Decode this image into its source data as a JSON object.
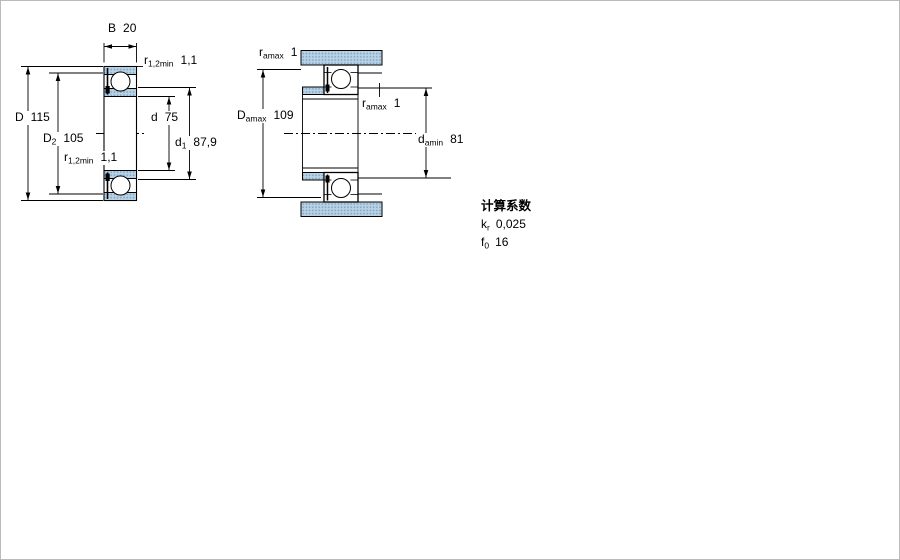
{
  "drawing": {
    "type": "bearing-cross-section-technical-drawing",
    "left_figure": {
      "dims": {
        "B": {
          "sym": "B",
          "sub": "",
          "value": "20"
        },
        "D": {
          "sym": "D",
          "sub": "",
          "value": "115"
        },
        "D2": {
          "sym": "D",
          "sub": "2",
          "value": "105"
        },
        "d": {
          "sym": "d",
          "sub": "",
          "value": "75"
        },
        "d1": {
          "sym": "d",
          "sub": "1",
          "value": "87,9"
        },
        "r12_top": {
          "sym": "r",
          "sub": "1,2min",
          "value": "1,1"
        },
        "r12_bot": {
          "sym": "r",
          "sub": "1,2min",
          "value": "1,1"
        }
      }
    },
    "right_figure": {
      "dims": {
        "ra_top": {
          "sym": "r",
          "sub": "amax",
          "value": "1"
        },
        "Damax": {
          "sym": "D",
          "sub": "amax",
          "value": "109"
        },
        "ra_mid": {
          "sym": "r",
          "sub": "amax",
          "value": "1"
        },
        "damin": {
          "sym": "d",
          "sub": "amin",
          "value": "81"
        }
      }
    },
    "calculation_factors": {
      "title": "计算系数",
      "kr": {
        "sym": "k",
        "sub": "r",
        "value": "0,025"
      },
      "f0": {
        "sym": "f",
        "sub": "0",
        "value": "16"
      }
    },
    "colors": {
      "hatch_base": "#b8d2e4",
      "hatch_dot": "#7fa3c6",
      "line": "#000000",
      "background": "#ffffff"
    }
  }
}
